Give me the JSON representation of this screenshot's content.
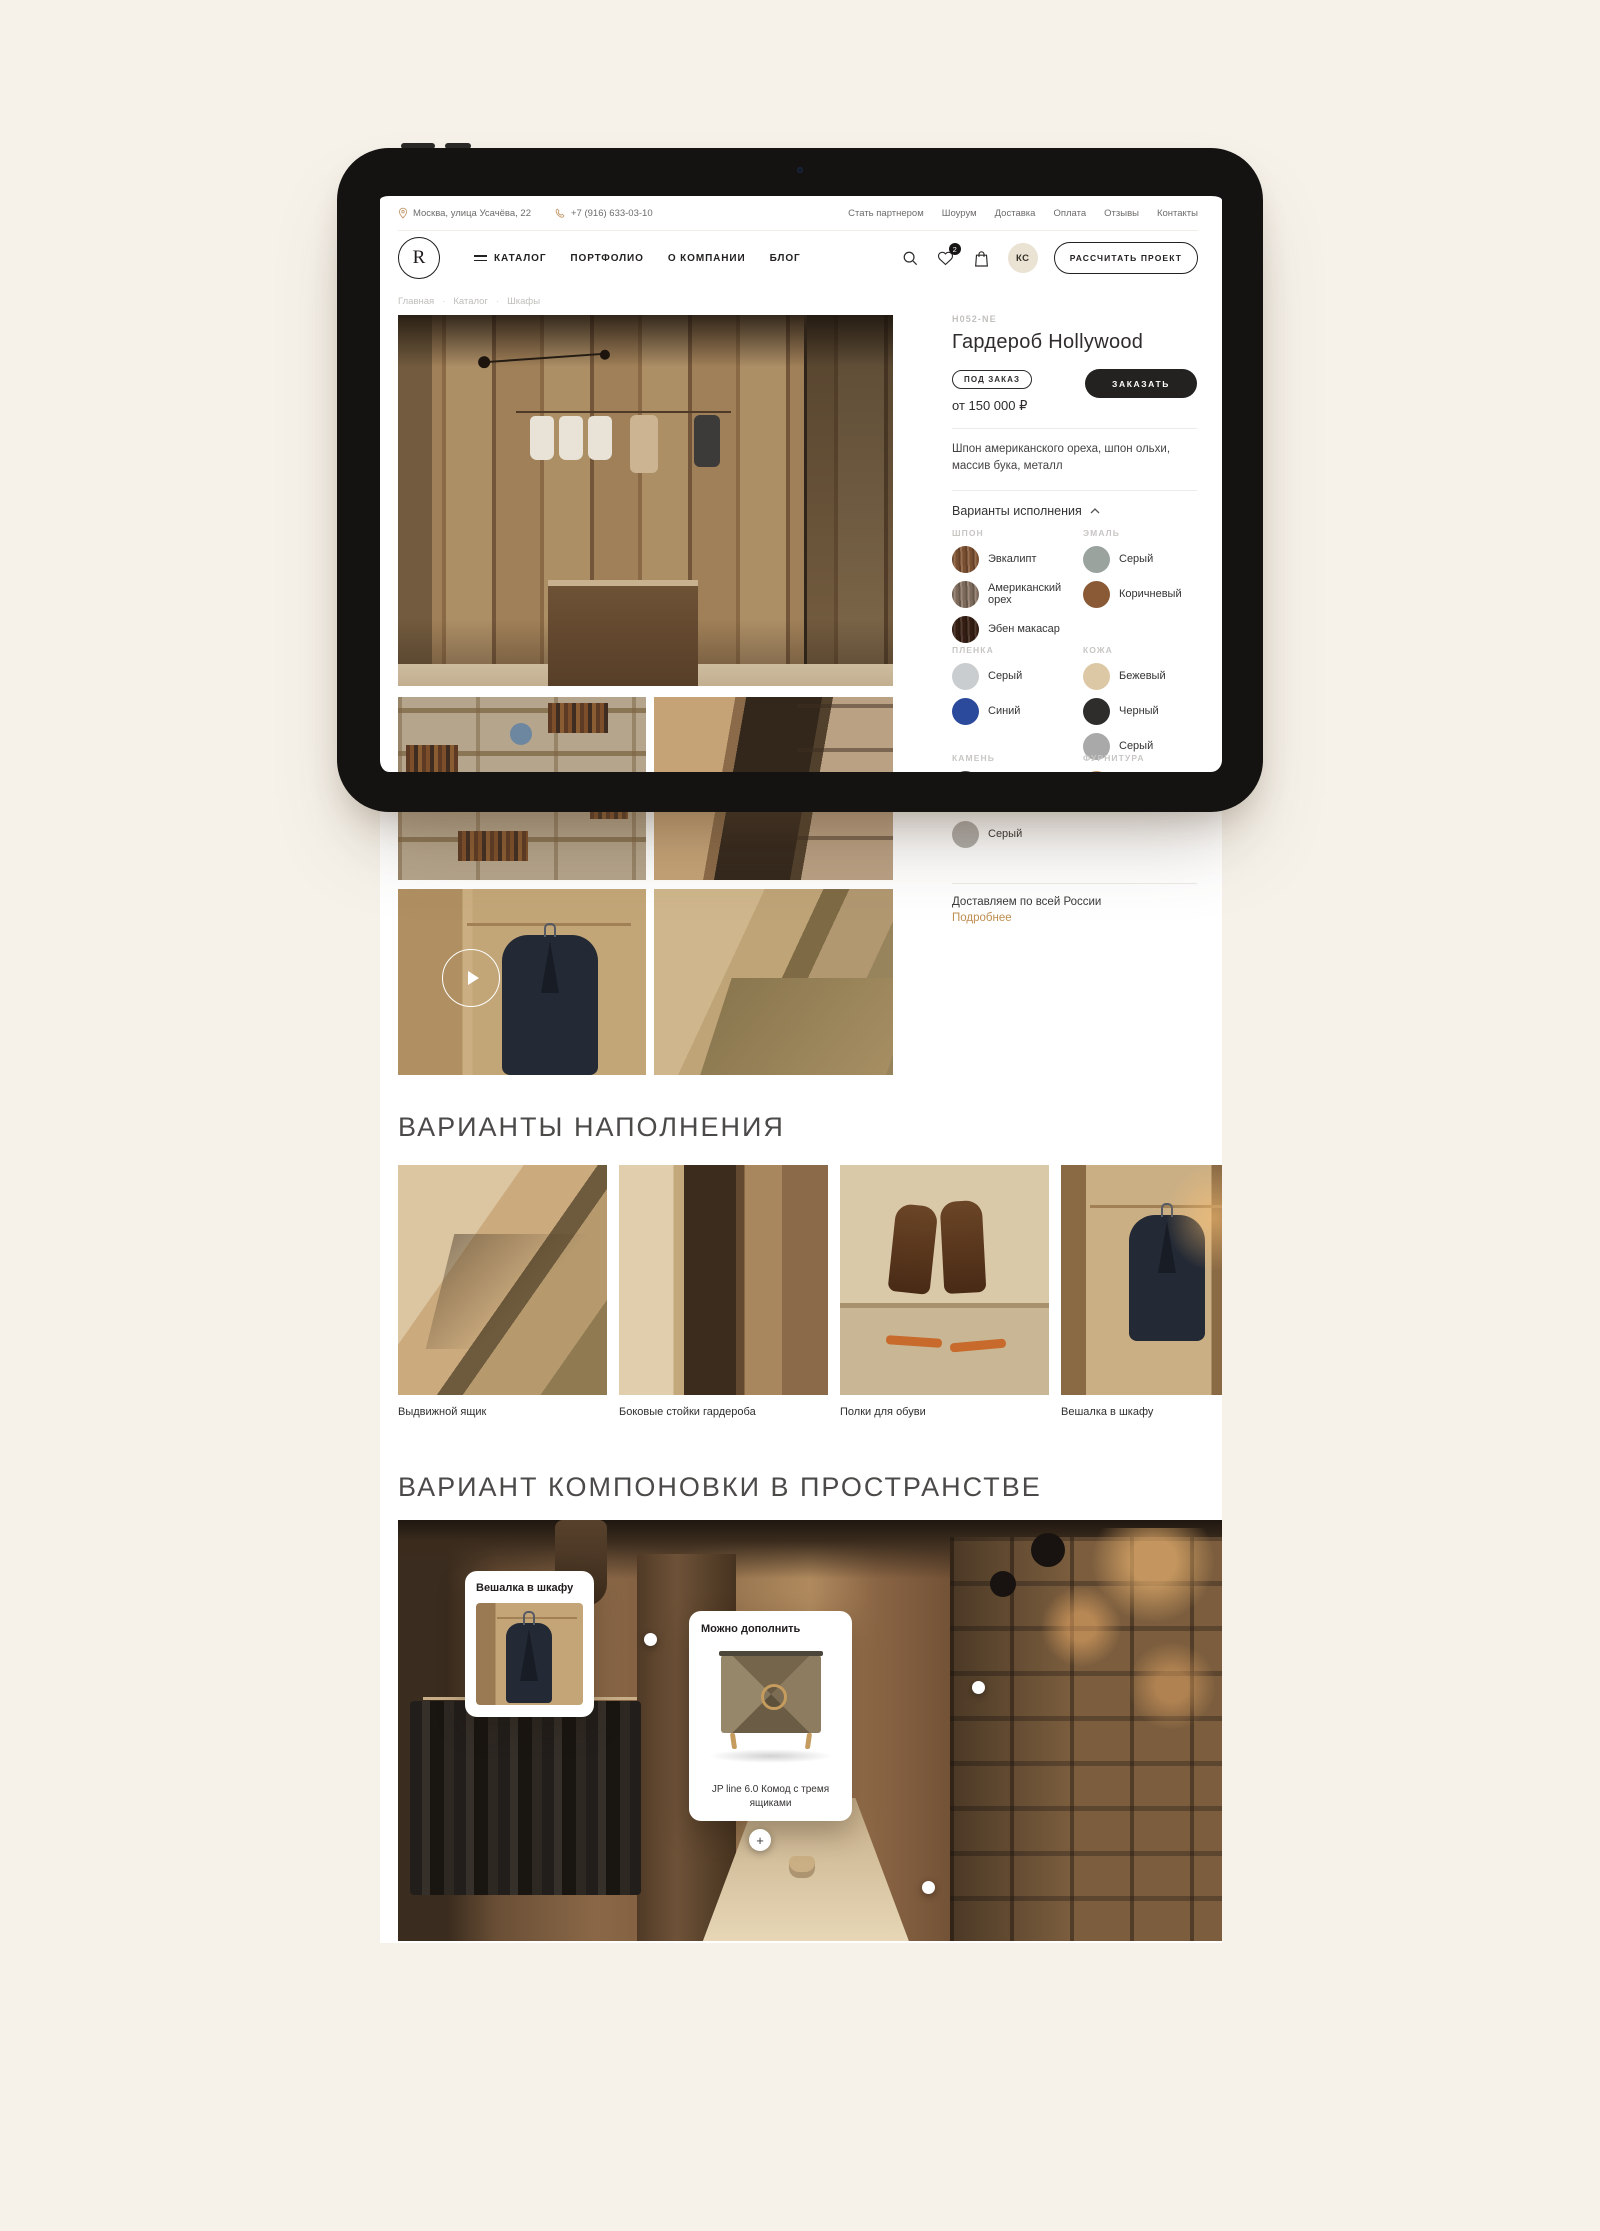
{
  "topbar": {
    "address": "Москва, улица Усачёва, 22",
    "phone": "+7 (916) 633-03-10",
    "links": [
      "Стать партнером",
      "Шоурум",
      "Доставка",
      "Оплата",
      "Отзывы",
      "Контакты"
    ]
  },
  "header": {
    "logo_letter": "R",
    "nav": [
      "КАТАЛОГ",
      "ПОРТФОЛИО",
      "О КОМПАНИИ",
      "БЛОГ"
    ],
    "favorites_count": "2",
    "avatar_initials": "КС",
    "cta": "РАССЧИТАТЬ ПРОЕКТ"
  },
  "breadcrumbs": [
    "Главная",
    "Каталог",
    "Шкафы"
  ],
  "product": {
    "sku": "H052-NE",
    "title": "Гардероб Hollywood",
    "availability_badge": "ПОД ЗАКАЗ",
    "price": "от 150 000 ₽",
    "order_button": "ЗАКАЗАТЬ",
    "description": "Шпон американского ореха, шпон ольхи, массив бука, металл",
    "variants_title": "Варианты исполнения",
    "groups": [
      {
        "name": "ШПОН",
        "options": [
          {
            "label": "Эвкалипт",
            "color": "#8a5a38"
          },
          {
            "label": "Американский орех",
            "color": "#8d7868"
          },
          {
            "label": "Эбен макасар",
            "color": "#3b2115"
          }
        ]
      },
      {
        "name": "ЭМАЛЬ",
        "options": [
          {
            "label": "Серый",
            "color": "#9aa39d"
          },
          {
            "label": "Коричневый",
            "color": "#8a5a36"
          }
        ]
      },
      {
        "name": "ПЛЕНКА",
        "options": [
          {
            "label": "Серый",
            "color": "#c9cdcf"
          },
          {
            "label": "Синий",
            "color": "#2c4a9c"
          }
        ]
      },
      {
        "name": "КОЖА",
        "options": [
          {
            "label": "Бежевый",
            "color": "#ddc8a6"
          },
          {
            "label": "Черный",
            "color": "#2e2d2b"
          },
          {
            "label": "Серый",
            "color": "#a9a9a9"
          }
        ]
      },
      {
        "name": "КАМЕНЬ",
        "options": [
          {
            "label": "Бежевый",
            "color": "#4c4b47"
          },
          {
            "label": "Серый",
            "color": "#b0aeab"
          }
        ]
      },
      {
        "name": "ФУРНИТУРА",
        "options": [
          {
            "label": "Латунь",
            "color": "#c29468"
          }
        ]
      }
    ],
    "delivery_note": "Доставляем по всей России",
    "more_link": "Подробнее"
  },
  "filling_section": {
    "title": "ВАРИАНТЫ НАПОЛНЕНИЯ",
    "items": [
      {
        "caption": "Выдвижной ящик"
      },
      {
        "caption": "Боковые стойки гардероба"
      },
      {
        "caption": "Полки для обуви"
      },
      {
        "caption": "Вешалка в шкафу"
      }
    ]
  },
  "layout_section": {
    "title": "ВАРИАНТ КОМПОНОВКИ В ПРОСТРАНСТВЕ",
    "hotspot_card": {
      "title": "Вешалка в шкафу"
    },
    "suggestion_card": {
      "title": "Можно дополнить",
      "caption": "JP line 6.0 Комод с тремя ящиками"
    },
    "hotspot_plus": "+"
  },
  "colors": {
    "page_bg": "#f6f2ea",
    "accent_link": "#bf8e51",
    "button_dark": "#242220"
  }
}
